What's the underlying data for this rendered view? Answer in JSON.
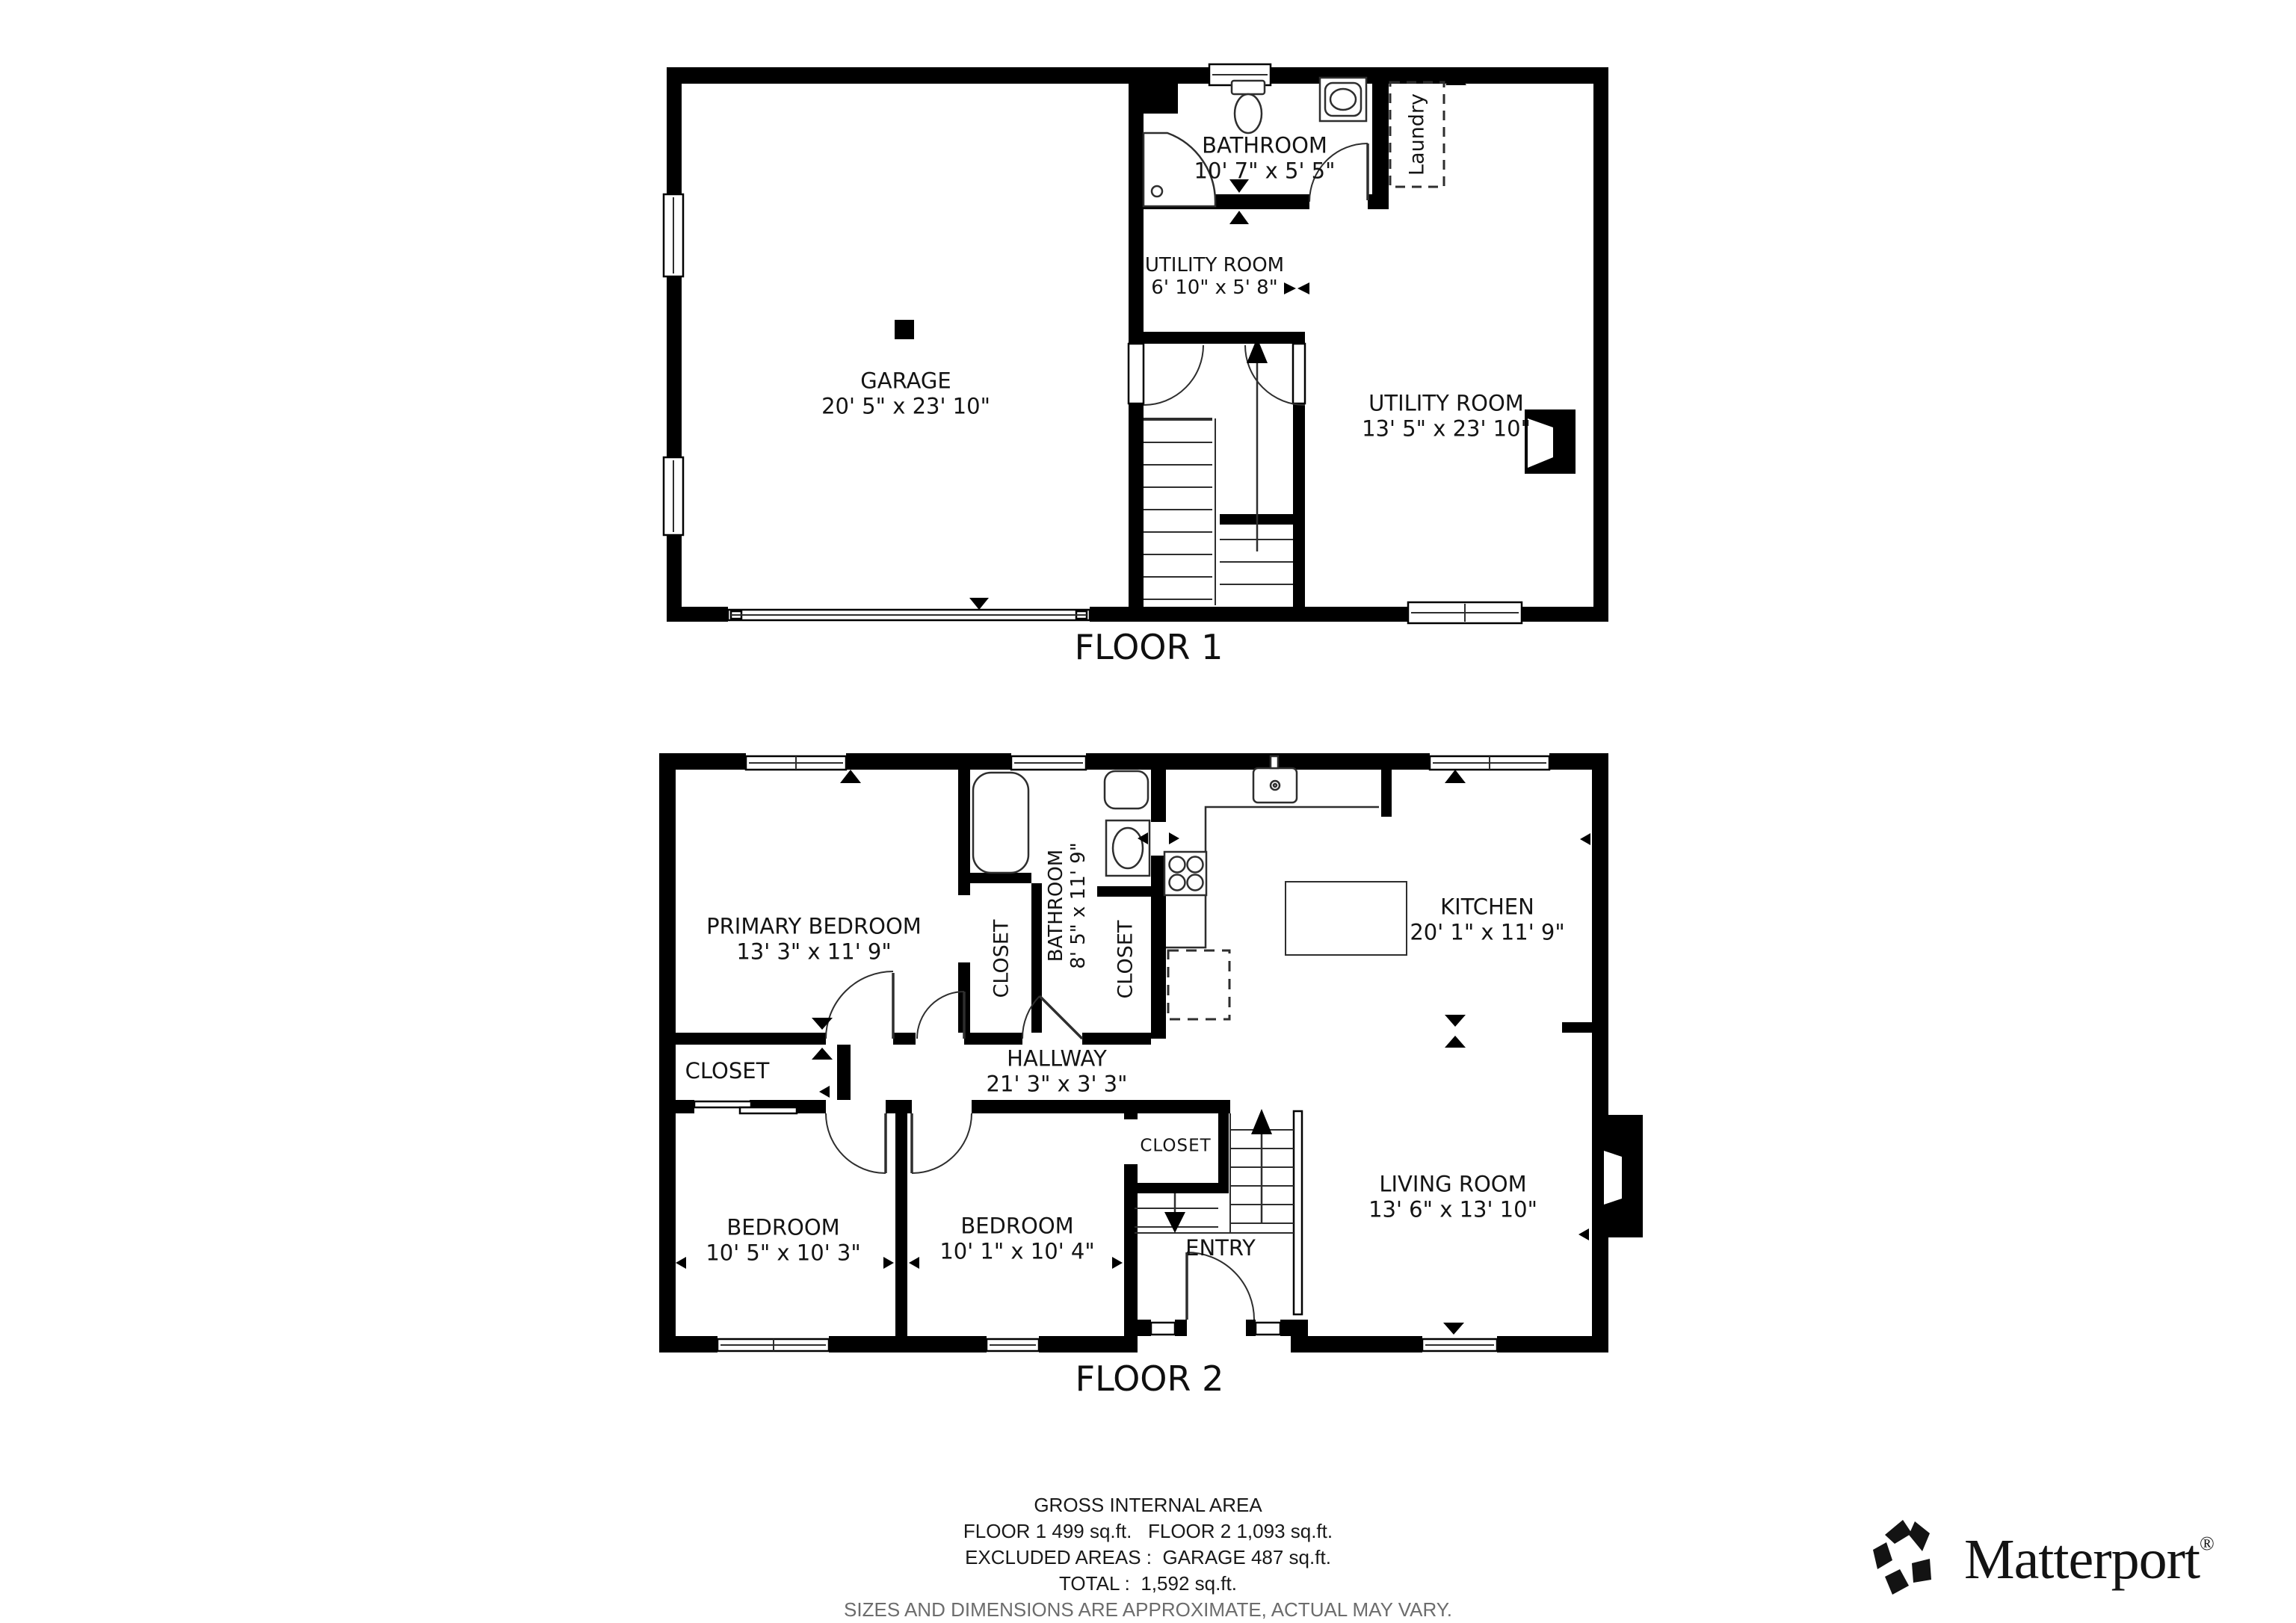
{
  "colors": {
    "wall": "#000000",
    "text": "#141414",
    "muted_text": "#6c6c6c",
    "background": "#ffffff"
  },
  "floor1": {
    "title": "FLOOR 1",
    "rooms": {
      "bathroom": {
        "name": "BATHROOM",
        "dims": "10' 7\" x 5' 5\""
      },
      "laundry": {
        "name": "Laundry"
      },
      "utility_small": {
        "name": "UTILITY ROOM",
        "dims": "6' 10\" x 5' 8\""
      },
      "garage": {
        "name": "GARAGE",
        "dims": "20' 5\" x 23' 10\""
      },
      "utility": {
        "name": "UTILITY ROOM",
        "dims": "13' 5\" x 23' 10\""
      }
    }
  },
  "floor2": {
    "title": "FLOOR 2",
    "rooms": {
      "primary_bedroom": {
        "name": "PRIMARY BEDROOM",
        "dims": "13' 3\" x 11' 9\""
      },
      "closet_primary": {
        "name": "CLOSET"
      },
      "bathroom": {
        "name": "BATHROOM",
        "dims": "8' 5\" x 11' 9\""
      },
      "closet_bath": {
        "name": "CLOSET"
      },
      "kitchen": {
        "name": "KITCHEN",
        "dims": "20' 1\" x 11' 9\""
      },
      "hallway": {
        "name": "HALLWAY",
        "dims": "21' 3\" x 3' 3\""
      },
      "closet_hallway": {
        "name": "CLOSET"
      },
      "bedroom_left": {
        "name": "BEDROOM",
        "dims": "10' 5\" x 10' 3\""
      },
      "bedroom_middle": {
        "name": "BEDROOM",
        "dims": "10' 1\" x 10' 4\""
      },
      "closet_entry": {
        "name": "CLOSET"
      },
      "entry": {
        "name": "ENTRY"
      },
      "living_room": {
        "name": "LIVING ROOM",
        "dims": "13' 6\" x 13' 10\""
      }
    }
  },
  "footer": {
    "line1": "GROSS INTERNAL AREA",
    "line2": "FLOOR 1 499 sq.ft.   FLOOR 2 1,093 sq.ft.",
    "line3": "EXCLUDED AREAS :  GARAGE 487 sq.ft.",
    "line4": "TOTAL :  1,592 sq.ft.",
    "line5": "SIZES AND DIMENSIONS ARE APPROXIMATE, ACTUAL MAY VARY."
  },
  "brand": {
    "name": "Matterport",
    "registered": "®"
  }
}
